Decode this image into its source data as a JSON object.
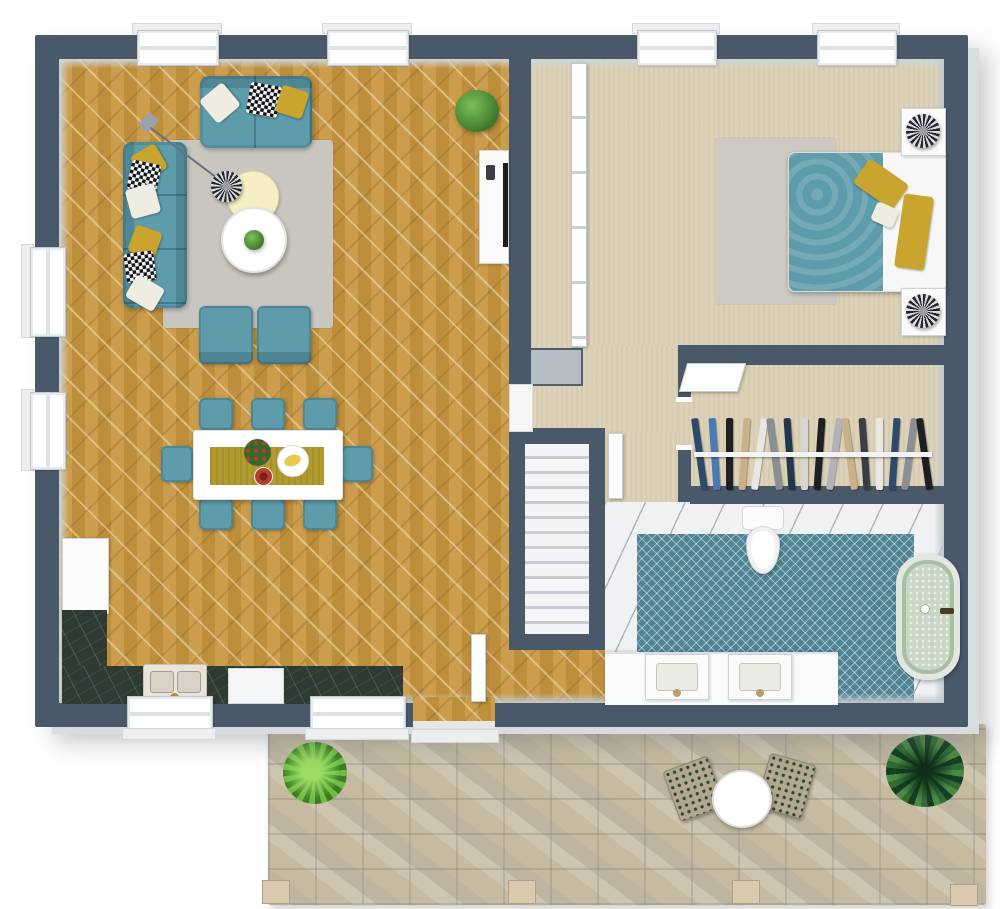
{
  "meta": {
    "view": "3D floor plan, top-down render",
    "dwelling": "one-bedroom apartment with patio"
  },
  "palette": {
    "wall": "#4a5969",
    "wallFace": "#cfd4d8",
    "wood": "#c7963f",
    "carpet": "#ddd2b8",
    "rug": "#c8c6bf",
    "bedroomRug": "#cdc9c1",
    "teal": "#5f9cab",
    "tealDark": "#47869a",
    "yellow": "#c9a52f",
    "paleYellow": "#f5efc3",
    "bathTile": "#4e8493",
    "whiteTile": "#eff1f2",
    "marble": "#2d3b33",
    "stone": "#c6bca4",
    "tub": "#c9d6c3",
    "stair": "#f3f4f6",
    "plantGreen": "#4c8a36"
  },
  "rooms": [
    {
      "name": "living-room",
      "floor": "herringbone-wood"
    },
    {
      "name": "dining-area",
      "floor": "herringbone-wood"
    },
    {
      "name": "kitchen",
      "floor": "herringbone-wood"
    },
    {
      "name": "hallway",
      "floor": "beige-carpet"
    },
    {
      "name": "bedroom",
      "floor": "beige-carpet"
    },
    {
      "name": "walk-in-closet",
      "floor": "beige-carpet"
    },
    {
      "name": "bathroom",
      "floor": "teal-chevron-tile with white tile border"
    },
    {
      "name": "staircase",
      "floor": "white-treads"
    },
    {
      "name": "patio",
      "floor": "natural-stone"
    }
  ],
  "furniture": {
    "living_room": [
      "3-seat teal sofa",
      "2-seat teal loveseat",
      "2 teal armchairs",
      "gray area rug",
      "round white coffee table with plant",
      "pale yellow pouf",
      "patterned pendant lamp",
      "white tv console with tv and remote",
      "potted plant"
    ],
    "dining_area": [
      "white dining table",
      "yellow table runner",
      "red flower bouquet",
      "plate of bananas",
      "red fruit bowl",
      "8 teal chairs"
    ],
    "kitchen": [
      "tall white cabinet",
      "dark marble corner counter",
      "double sink with brass faucet",
      "white built-in appliance"
    ],
    "bedroom": [
      "double bed with teal duvet and yellow pillows",
      "2 white nightstands",
      "2 patterned ball lamps",
      "gray area rug",
      "white panel partition"
    ],
    "closet": [
      "hanging rail with clothes"
    ],
    "bathroom": [
      "toilet",
      "freestanding speckled tub",
      "double vanity with 2 sinks"
    ],
    "patio": [
      "round white table",
      "2 dotted chairs",
      "fern plant",
      "spiky plant",
      "4 fence posts"
    ]
  },
  "closet": {
    "clothes_colors": [
      "#2e4a6b",
      "#4a7ab5",
      "#1d1f23",
      "#c9b289",
      "#e8e7e3",
      "#8a8f96",
      "#23364f",
      "#d7d5cf",
      "#1d1f23",
      "#b0b4ba",
      "#c9b289",
      "#3a3d45",
      "#e8e7e3",
      "#2e4a6b",
      "#8a8f96",
      "#1d1f23"
    ]
  }
}
